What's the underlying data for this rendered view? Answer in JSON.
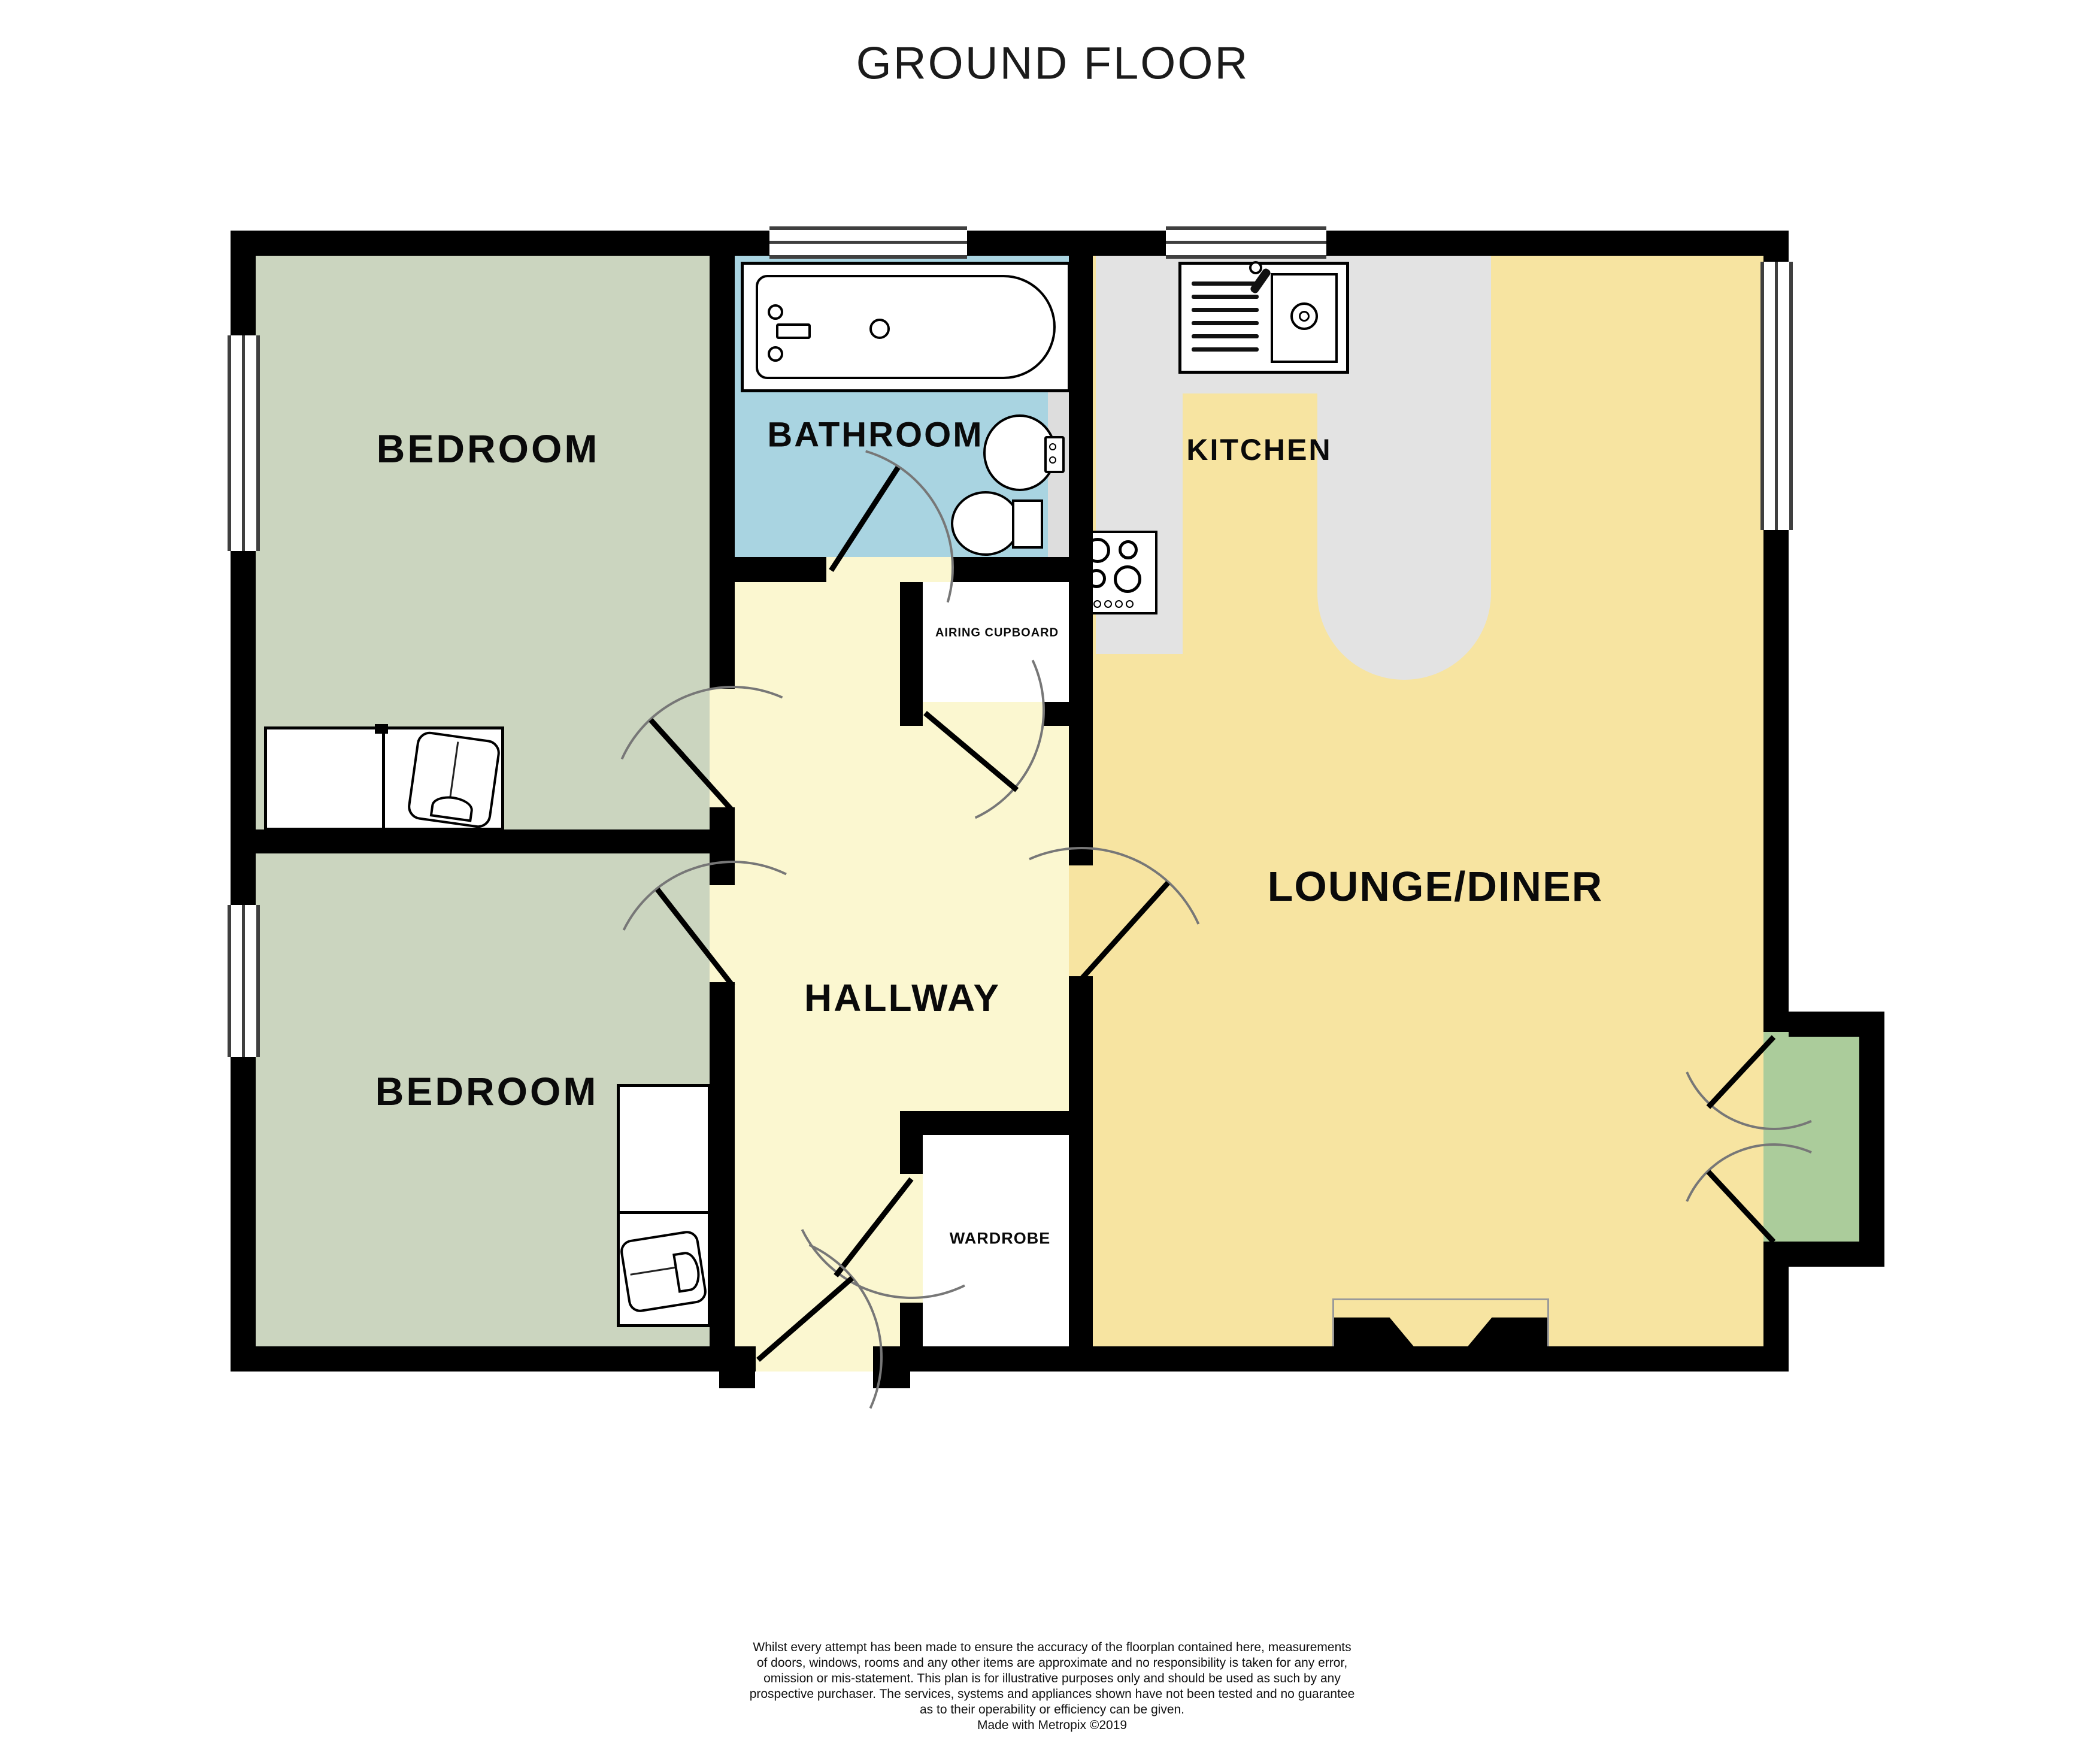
{
  "title": "GROUND FLOOR",
  "rooms": {
    "bedroom1": {
      "label": "BEDROOM",
      "color": "#CBD5BF"
    },
    "bedroom2": {
      "label": "BEDROOM",
      "color": "#CBD5BF"
    },
    "bathroom": {
      "label": "BATHROOM",
      "color": "#A9D4E1"
    },
    "kitchen": {
      "label": "KITCHEN",
      "floor_color": "#F7E4A1",
      "counter_color": "#E3E3E3"
    },
    "lounge_diner": {
      "label": "LOUNGE/DINER",
      "color": "#F7E4A1"
    },
    "hallway": {
      "label": "HALLWAY",
      "color": "#FBF7D0"
    },
    "airing_cupboard": {
      "label": "AIRING CUPBOARD",
      "color": "#FFFFFF"
    },
    "wardrobe": {
      "label": "WARDROBE",
      "color": "#FFFFFF"
    }
  },
  "porch": {
    "color": "#ABCC9B"
  },
  "wall_color": "#000000",
  "disclaimer": {
    "lines": [
      "Whilst every attempt has been made to ensure the accuracy of the floorplan contained here, measurements",
      "of doors, windows, rooms and any other items are approximate and no responsibility is taken for any error,",
      "omission or mis-statement. This plan is for illustrative purposes only and should be used as such by any",
      "prospective purchaser. The services, systems and appliances shown have not been tested and no guarantee",
      "as to their operability or efficiency can be given.",
      "Made with Metropix ©2019"
    ]
  }
}
